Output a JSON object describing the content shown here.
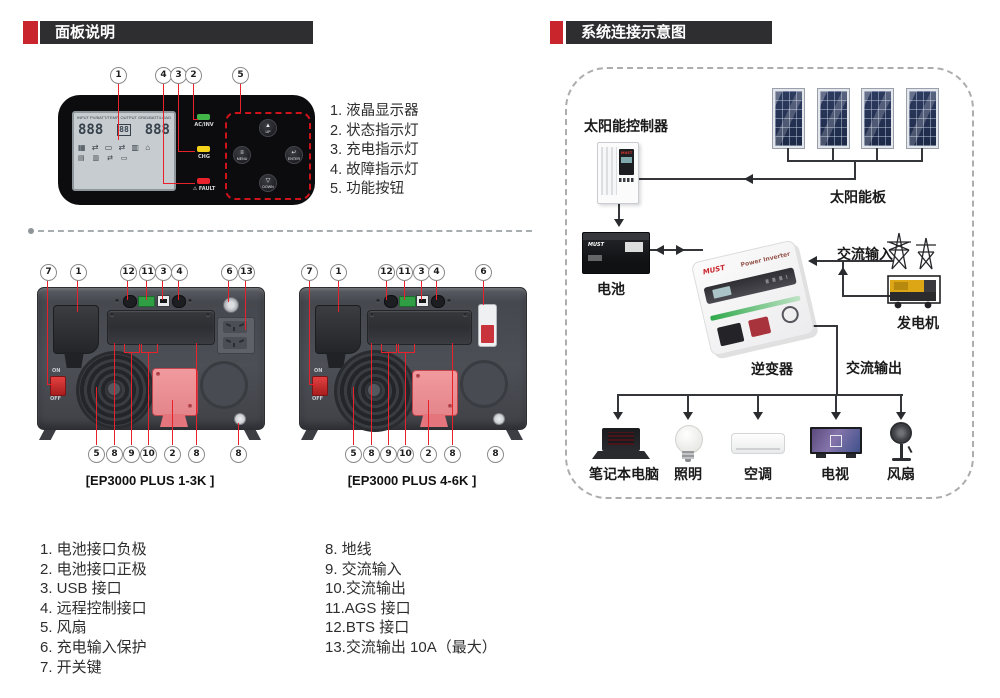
{
  "colors": {
    "accent_red": "#c9252c",
    "header_bar": "#2e2e30",
    "callout_line": "#e8212a"
  },
  "left_section": {
    "header": "面板说明",
    "panel_figure": {
      "callouts": [
        "1",
        "4",
        "3",
        "2",
        "5"
      ],
      "lcd": {
        "top_left": "INPUT PV/BATT/TEMP",
        "top_right": "OUTPUT GRID/BATT/LOAD",
        "digits_left": "888",
        "digits_center": "88",
        "digits_right": "888",
        "icons": "▦ ⇄ ▭ ⇄ ▥ ⌂"
      },
      "indicators": [
        {
          "label": "AC/INV",
          "color": "#43b649"
        },
        {
          "label": "CHG",
          "color": "#f5d31b"
        },
        {
          "label": "⚠ FAULT",
          "color": "#e8212a"
        }
      ],
      "buttons": [
        {
          "glyph": "▲",
          "label": "UP"
        },
        {
          "glyph": "≡",
          "label": "MENU"
        },
        {
          "glyph": "↵",
          "label": "ENTER"
        },
        {
          "glyph": "▽",
          "label": "DOWN"
        }
      ]
    },
    "panel_legend": [
      "1. 液晶显示器",
      "2. 状态指示灯",
      "3. 充电指示灯",
      "4. 故障指示灯",
      "5. 功能按钮"
    ],
    "rear_panels": [
      {
        "label": "[EP3000 PLUS 1-3K ]",
        "top_callouts": [
          "7",
          "1",
          "12",
          "11",
          "3",
          "4",
          "6",
          "13"
        ],
        "bottom_callouts": [
          "5",
          "8",
          "9",
          "10",
          "2",
          "8",
          "8"
        ],
        "switch": {
          "on": "ON",
          "off": "OFF"
        }
      },
      {
        "label": "[EP3000 PLUS 4-6K ]",
        "top_callouts": [
          "7",
          "1",
          "12",
          "11",
          "3",
          "4",
          "6"
        ],
        "bottom_callouts": [
          "5",
          "8",
          "9",
          "10",
          "2",
          "8",
          "8"
        ],
        "switch": {
          "on": "ON",
          "off": "OFF"
        }
      }
    ],
    "port_legend_left": [
      "1. 电池接口负极",
      "2. 电池接口正极",
      "3. USB 接口",
      "4. 远程控制接口",
      "5. 风扇",
      "6. 充电输入保护",
      "7. 开关键"
    ],
    "port_legend_right": [
      "8. 地线",
      "9. 交流输入",
      "10.交流输出",
      "11.AGS 接口",
      "12.BTS 接口",
      "13.交流输出 10A（最大）"
    ]
  },
  "right_section": {
    "header": "系统连接示意图",
    "brand": "MUST",
    "inverter_caption": "Power Inverter",
    "nodes": {
      "solar_controller": "太阳能控制器",
      "solar_panels": "太阳能板",
      "battery": "电池",
      "inverter": "逆变器",
      "ac_input": "交流输入",
      "generator": "发电机",
      "ac_output": "交流输出",
      "laptop": "笔记本电脑",
      "lighting": "照明",
      "air_conditioner": "空调",
      "tv": "电视",
      "fan": "风扇"
    }
  }
}
